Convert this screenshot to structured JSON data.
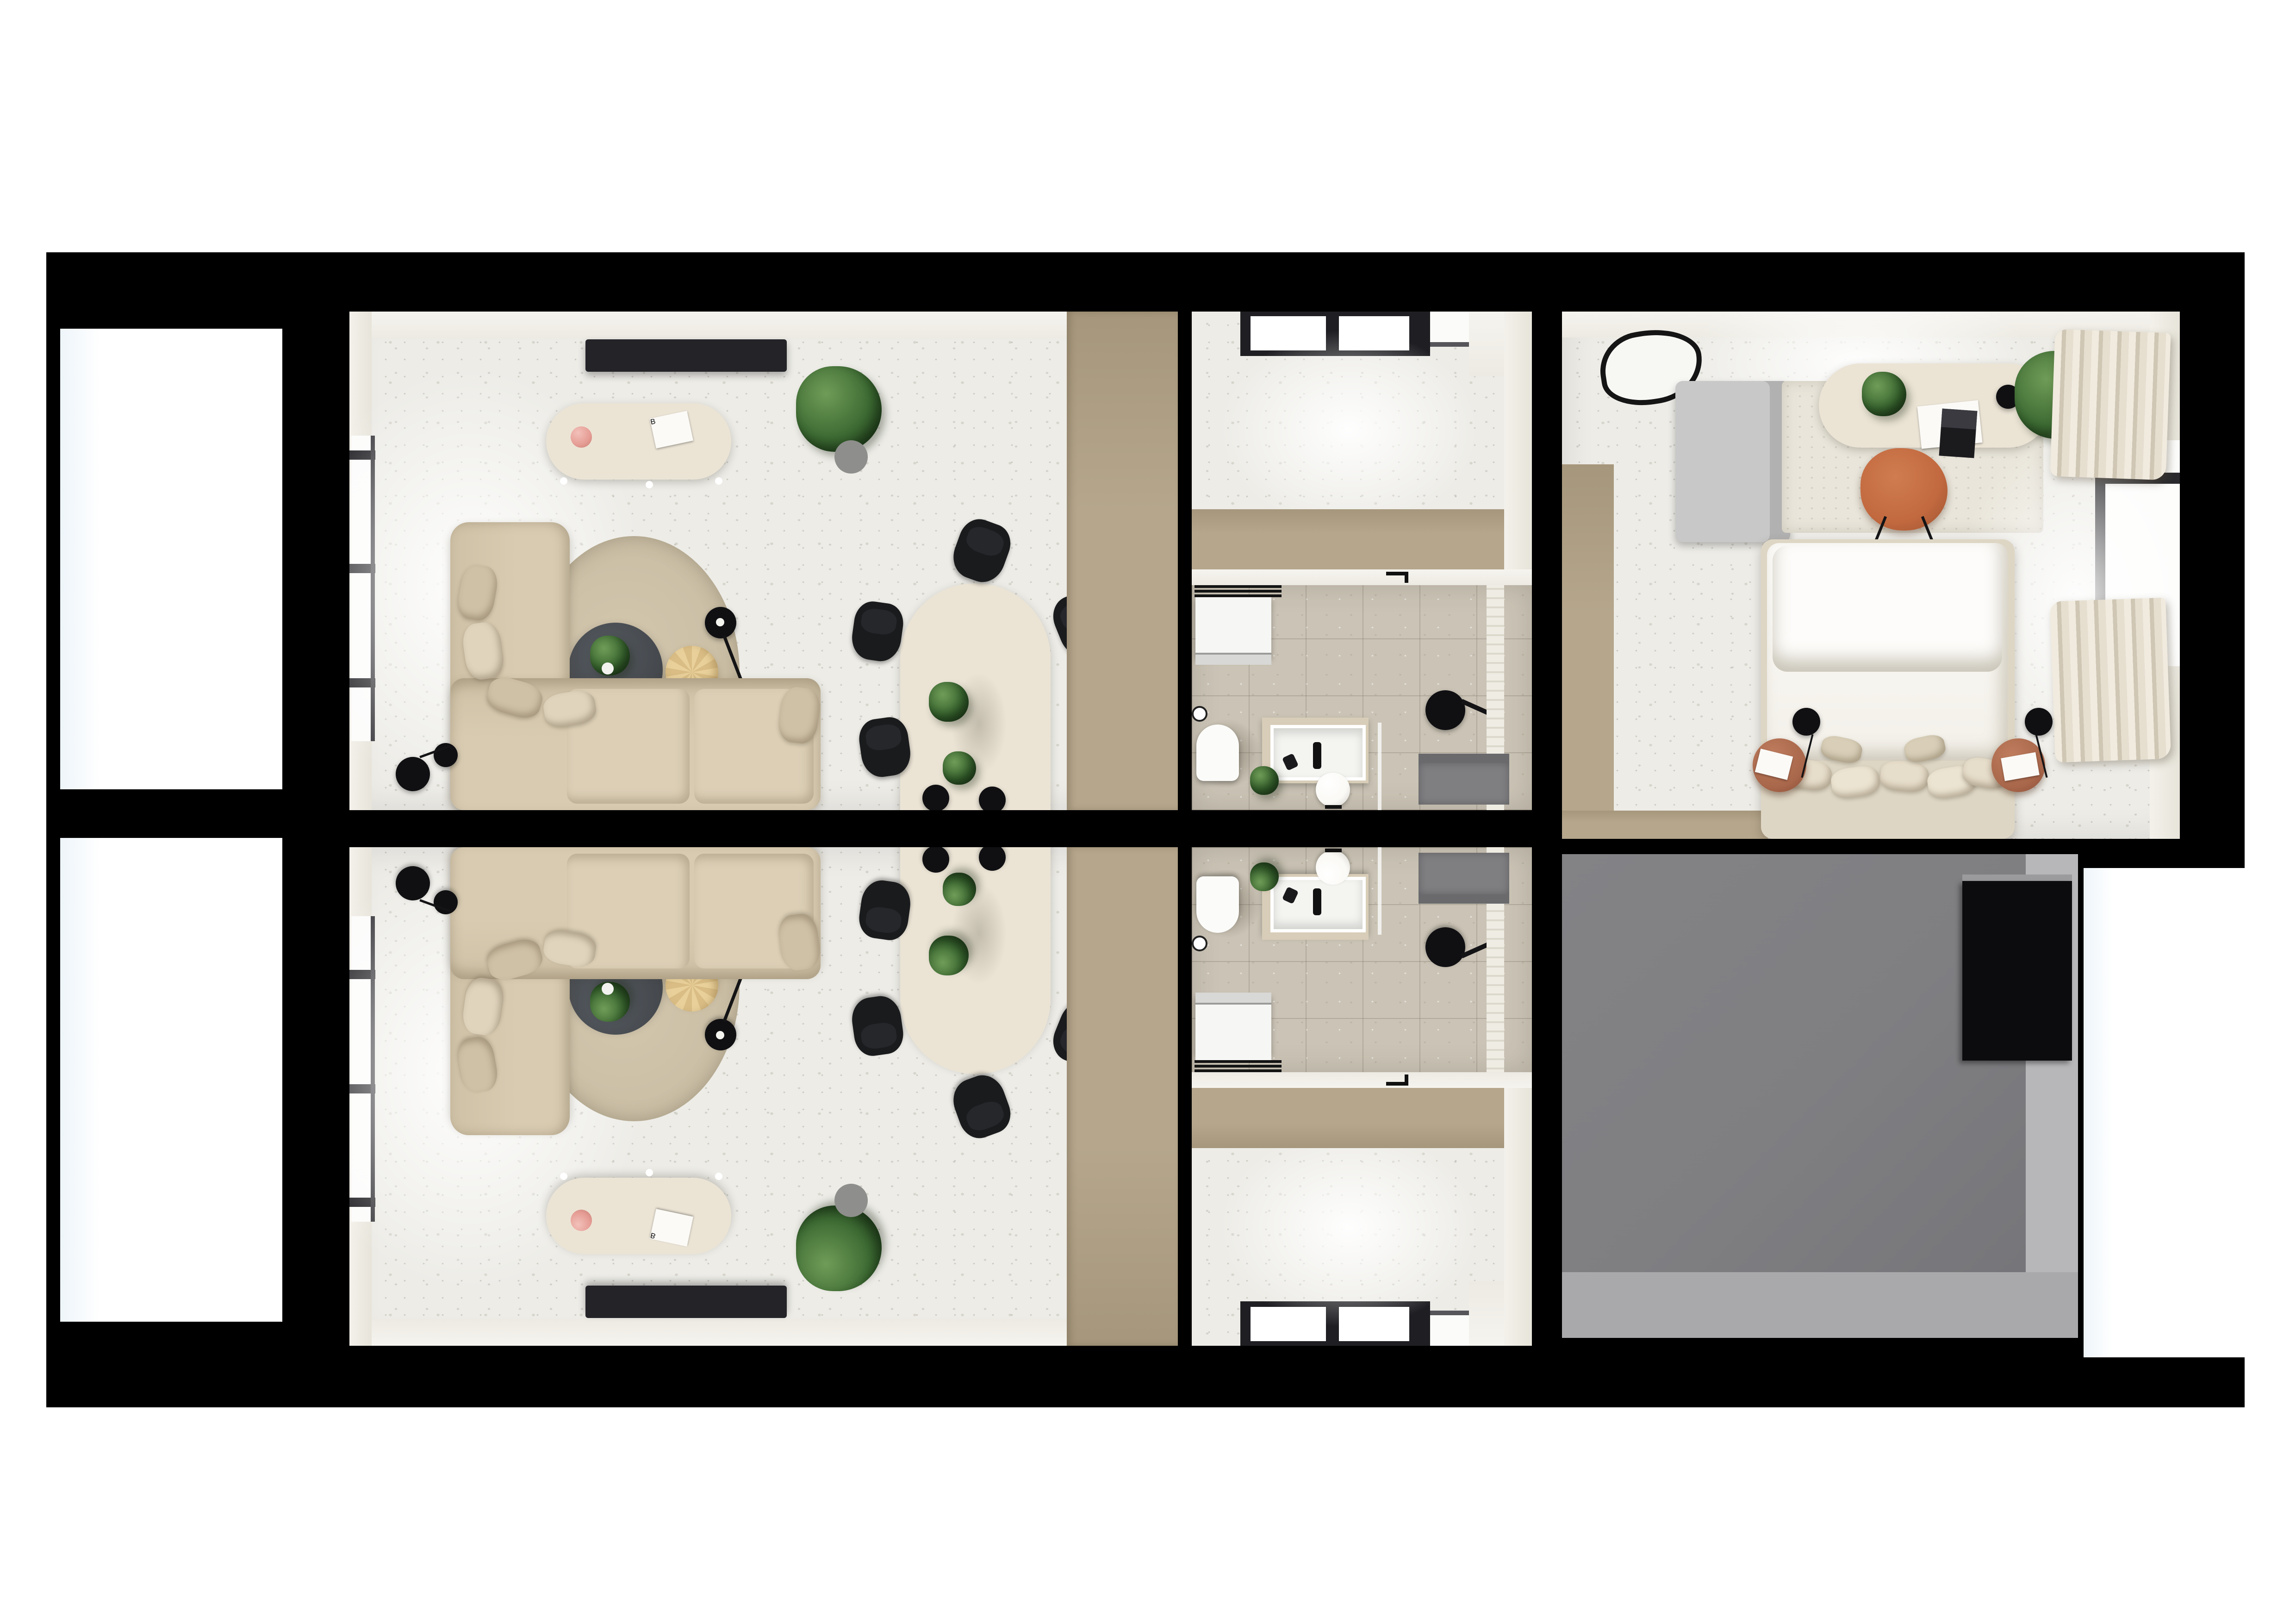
{
  "scene": {
    "type": "3d-floor-plan-render",
    "view": "top-down",
    "description": "Photorealistic top-down render of two vertically mirrored apartment units: each with a living/dining room (left), entry hall and bathroom (middle); a furnished bedroom top-right; an unfinished gray utility room bottom-right. Thick black walls on white background.",
    "background": "#ffffff"
  },
  "theme": {
    "page": "#ffffff",
    "wall": "#000000",
    "floor": "#edece7",
    "floor_tan": "#b5a68c",
    "floor_tan_d": "#a6977c",
    "floor_bath": "#cbc4b6",
    "cream": "#ebe4d5",
    "sofa": "#d8cbb1",
    "cushion": "#dccfb6",
    "cushion2": "#cfc1a6",
    "rug": "#c8bca3",
    "rug_light": "#e9e5da",
    "table_dark": "#45494e",
    "chair_black": "#1a1b1d",
    "pouf": "#e9d09a",
    "terracotta": "#c2693f",
    "nightstand": "#a8664a",
    "plant": "#3d6b33",
    "plant_dark": "#24401f",
    "gray_room": "#7f7f82",
    "gray_light": "#b7b7ba",
    "gray_mid": "#a9a9ac",
    "curtain_a": "#f1ebdf",
    "curtain_b": "#cfc6b4",
    "tv": "#232328",
    "accent_red": "#c03a2b",
    "vase_pink": "#e59c94",
    "lamp_ball": "#faf9f5"
  },
  "labels": {
    "book_letter": "B"
  },
  "rooms": [
    {
      "id": "living-room-a",
      "mirrored": false,
      "furniture": [
        "tv-panel",
        "console-sideboard",
        "pink-vase",
        "art-book",
        "fiddle-leaf-plant",
        "round-rug",
        "coffee-table",
        "coffee-table-plant",
        "pouf",
        "arc-floor-lamp",
        "corner-sofa",
        "cushions",
        "dining-table",
        "dining-chairs",
        "dining-table-plants",
        "planter-pots",
        "wall-lamp",
        "curtains",
        "window",
        "entry-floor-strip"
      ]
    },
    {
      "id": "living-room-b",
      "mirrored": true,
      "furniture": [
        "tv-panel",
        "console-sideboard",
        "pink-vase",
        "art-book",
        "fiddle-leaf-plant",
        "round-rug",
        "coffee-table",
        "coffee-table-plant",
        "pouf",
        "arc-floor-lamp",
        "corner-sofa",
        "cushions",
        "dining-table",
        "dining-chairs",
        "dining-table-plants",
        "planter-pots",
        "wall-lamp",
        "curtains",
        "window",
        "entry-floor-strip"
      ]
    },
    {
      "id": "hallway-a",
      "mirrored": false,
      "furniture": [
        "entry-window",
        "doormat-floor"
      ]
    },
    {
      "id": "hallway-b",
      "mirrored": true,
      "furniture": [
        "entry-window",
        "doormat-floor"
      ]
    },
    {
      "id": "bathroom-a",
      "mirrored": false,
      "furniture": [
        "washing-machine",
        "wire-shelf",
        "interior-door",
        "toilet",
        "toilet-paper-holder",
        "vanity-counter",
        "sink",
        "faucet",
        "ball-lamp",
        "plant",
        "rain-shower-head",
        "shower-glass",
        "tiled-wall",
        "service-duct"
      ]
    },
    {
      "id": "bathroom-b",
      "mirrored": true,
      "furniture": [
        "washing-machine",
        "wire-shelf",
        "interior-door",
        "toilet",
        "toilet-paper-holder",
        "vanity-counter",
        "sink",
        "faucet",
        "ball-lamp",
        "plant",
        "rain-shower-head",
        "shower-glass",
        "tiled-wall",
        "service-duct"
      ]
    },
    {
      "id": "bedroom",
      "furniture": [
        "wall-mirror",
        "wardrobe",
        "desk",
        "desk-plant",
        "papers",
        "laptop",
        "desk-lamp",
        "office-chair",
        "area-rug",
        "floor-plant",
        "curtains",
        "window",
        "double-bed",
        "duvet",
        "pillows",
        "nightstand-left",
        "nightstand-right",
        "wall-sconces",
        "magazines"
      ]
    },
    {
      "id": "utility-room",
      "furniture": [
        "dark-wall-opening"
      ]
    }
  ]
}
